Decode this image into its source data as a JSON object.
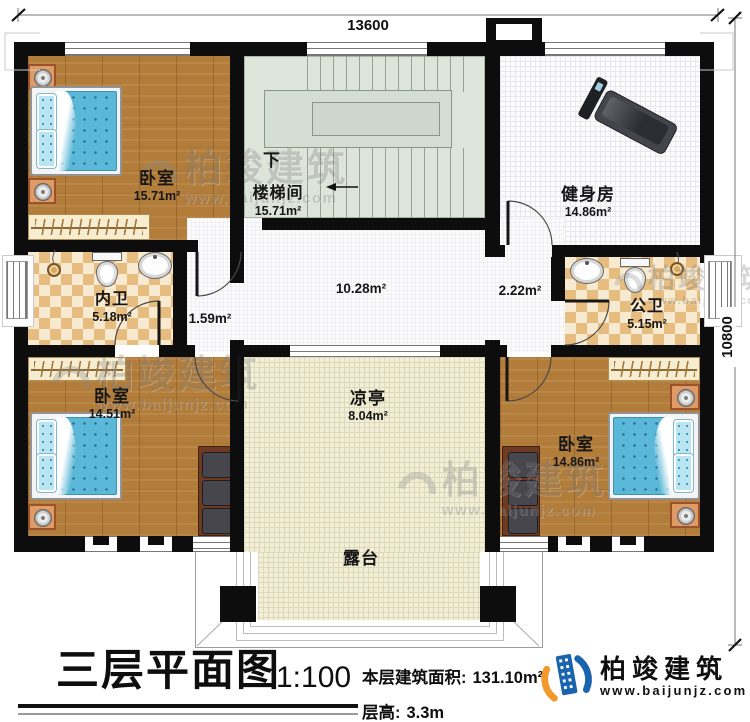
{
  "dimensions": {
    "top": "13600",
    "right": "10800"
  },
  "rooms": {
    "bedroom_tl": {
      "name": "卧室",
      "area": "15.71m²"
    },
    "stairwell": {
      "name": "楼梯间",
      "area": "15.71m²",
      "down_label": "下"
    },
    "gym": {
      "name": "健身房",
      "area": "14.86m²"
    },
    "bath_inner": {
      "name": "内卫",
      "area": "5.18m²"
    },
    "bath_public": {
      "name": "公卫",
      "area": "5.15m²"
    },
    "bedroom_bl": {
      "name": "卧室",
      "area": "14.51m²"
    },
    "bedroom_br": {
      "name": "卧室",
      "area": "14.86m²"
    },
    "pavilion": {
      "name": "凉亭",
      "area": "8.04m²"
    },
    "terrace": {
      "name": "露台"
    },
    "hall_center": {
      "area": "10.28m²"
    },
    "hall_west": {
      "area": "1.59m²"
    },
    "hall_east": {
      "area": "2.22m²"
    }
  },
  "titleblock": {
    "title": "三层平面图",
    "scale": "1:100",
    "floor_area_label": "本层建筑面积:",
    "floor_area_value": "131.10m²",
    "floor_height_label": "层高:",
    "floor_height_value": "3.3m"
  },
  "brand": {
    "name": "柏竣建筑",
    "url": "www.baijunjz.com"
  },
  "watermark": {
    "name": "柏竣建筑",
    "url": "www.baijunjz.com"
  },
  "colors": {
    "wall": "#0d0d0d",
    "wood": "#b27c3a",
    "stair": "#dde4da",
    "bath_checker": "#e7bd7f",
    "cream": "#f2efd8",
    "bed_blue": "#5cb8d8",
    "logo_blue": "#1a63ad",
    "logo_orange": "#f2992e"
  }
}
